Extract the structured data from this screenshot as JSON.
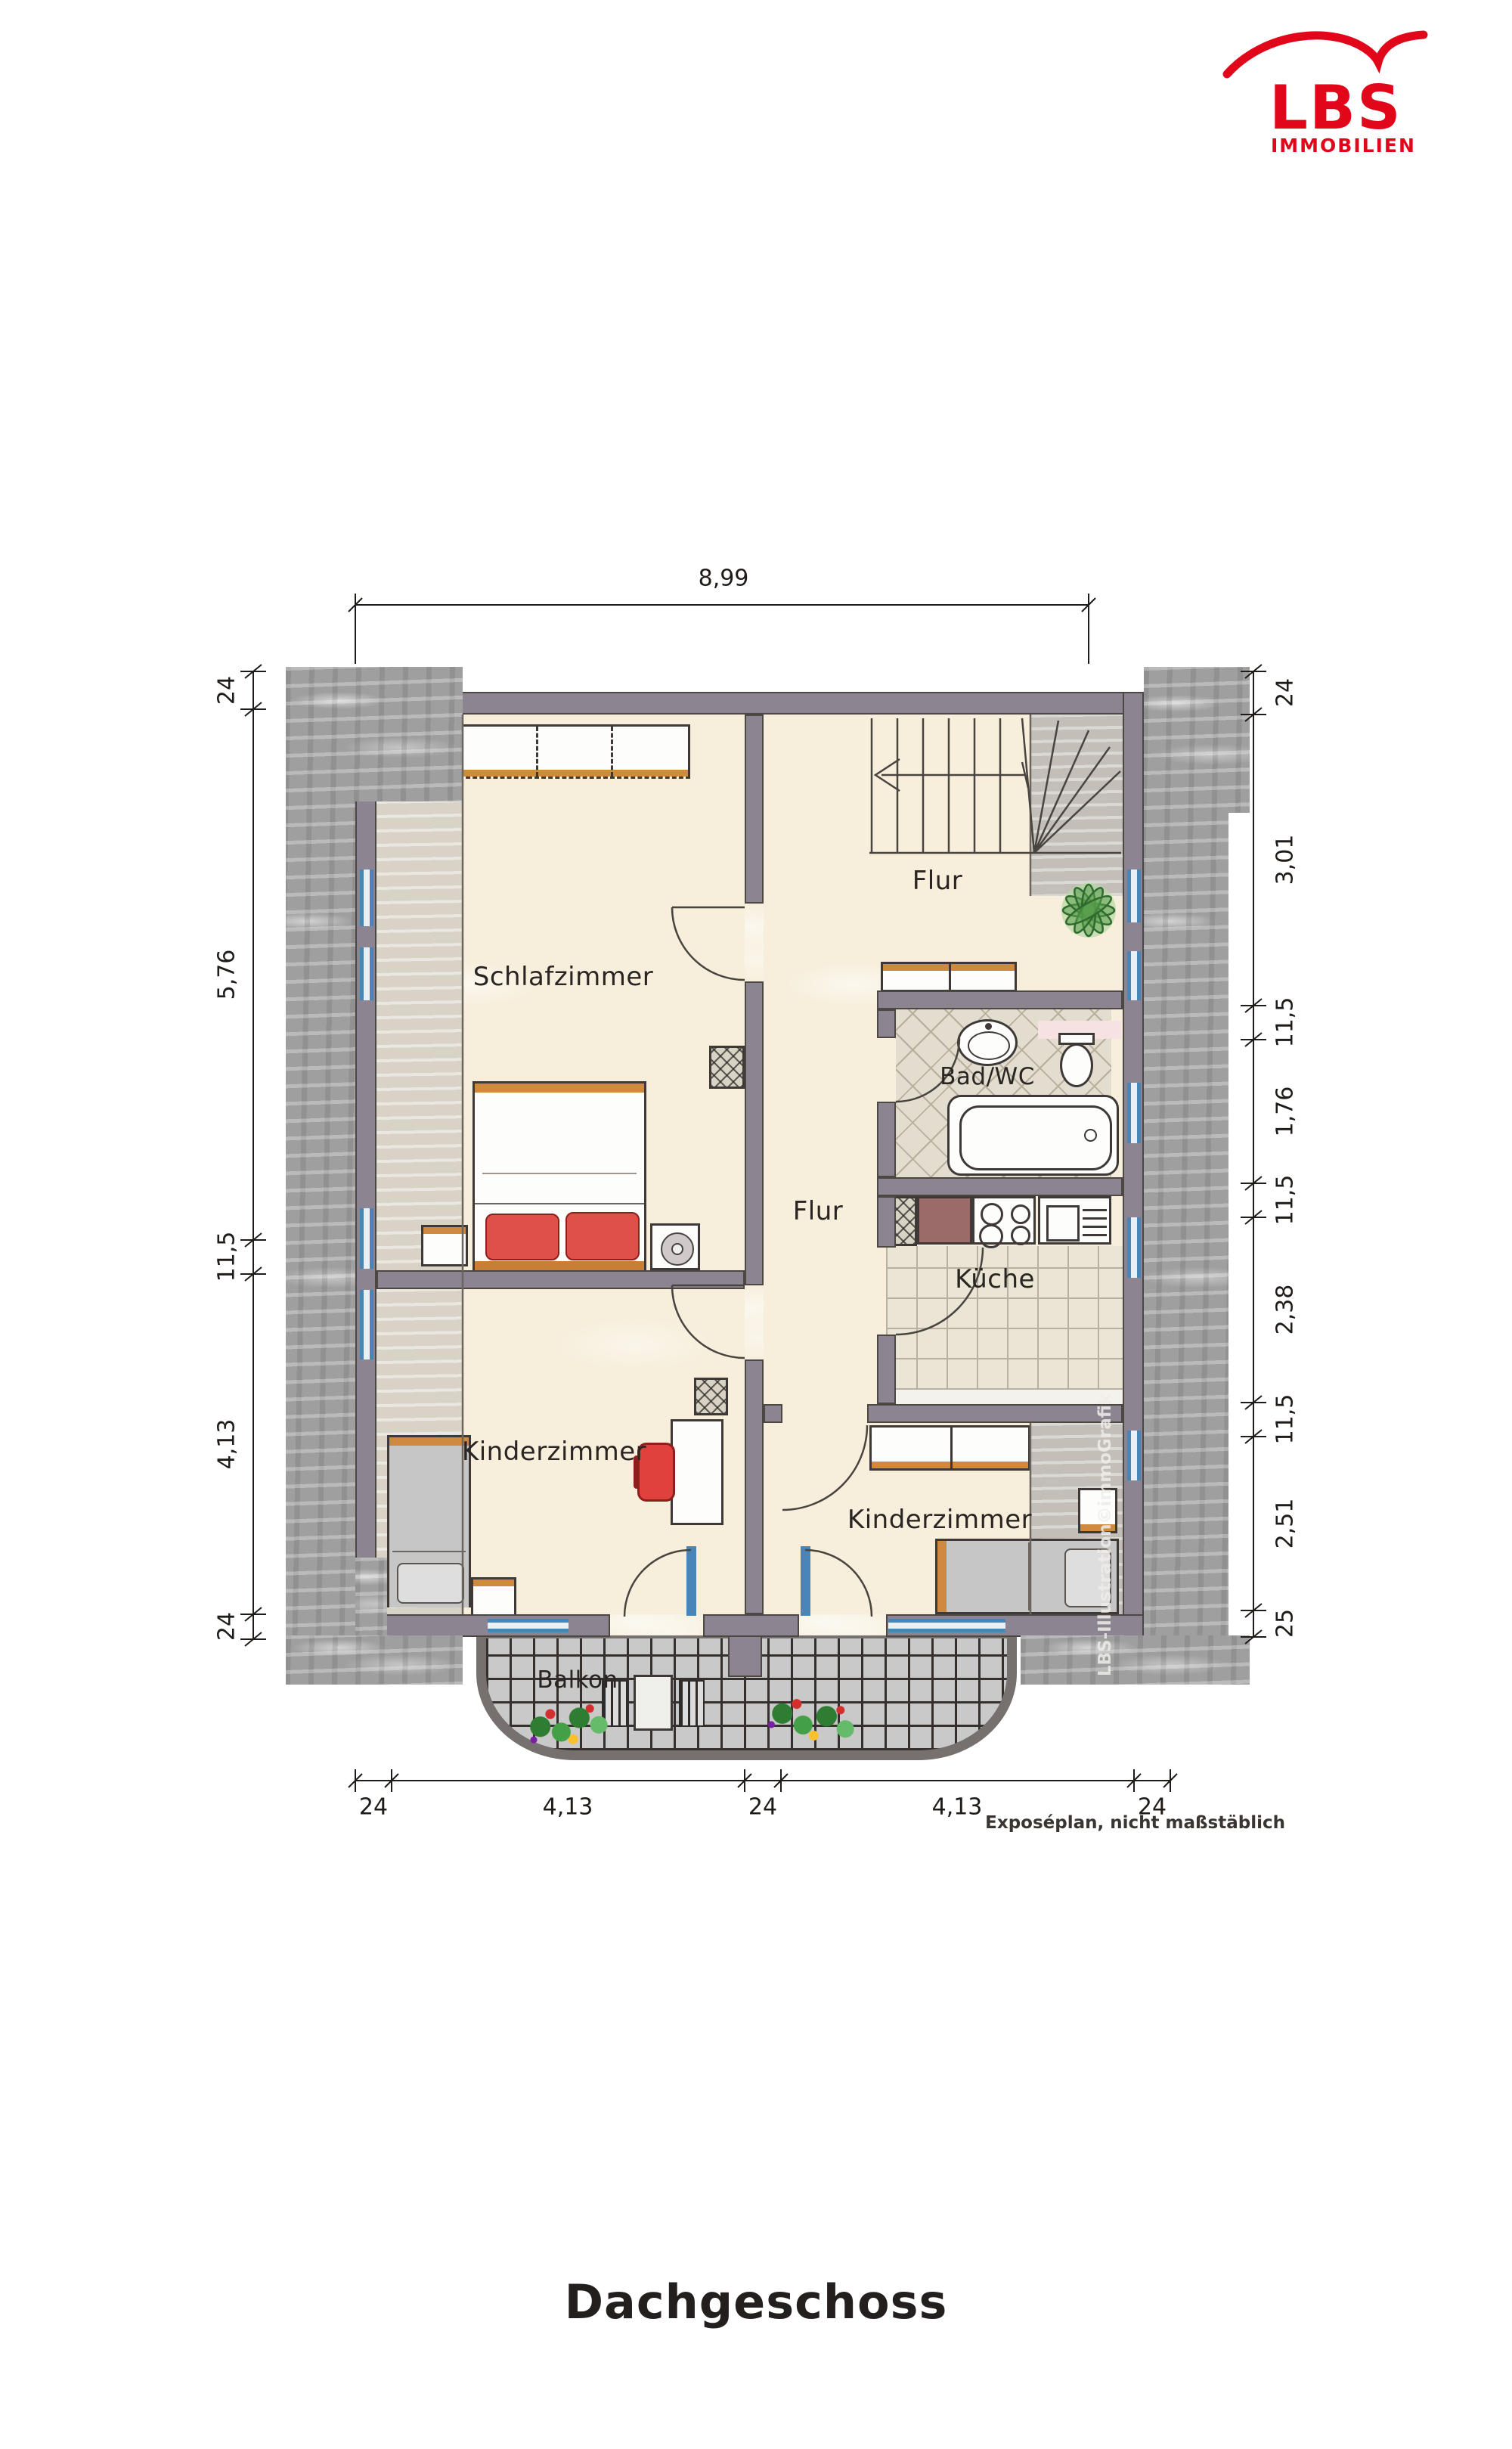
{
  "logo": {
    "name": "LBS",
    "tagline": "IMMOBILIEN"
  },
  "title": "Dachgeschoss",
  "footnote": "Exposéplan, nicht maßstäblich",
  "watermark": "LBS-Illustration©immoGrafik",
  "rooms": [
    {
      "label": "Schlafzimmer"
    },
    {
      "label": "Flur"
    },
    {
      "label": "Bad/WC"
    },
    {
      "label": "Flur"
    },
    {
      "label": "Küche"
    },
    {
      "label": "Kinderzimmer"
    },
    {
      "label": "Kinderzimmer"
    },
    {
      "label": "Balkon"
    }
  ],
  "dimensions": {
    "top": [
      "8,99"
    ],
    "left": [
      "24",
      "5,76",
      "11,5",
      "4,13",
      "24"
    ],
    "right": [
      "24",
      "3,01",
      "11,5",
      "1,76",
      "11,5",
      "2,38",
      "11,5",
      "2,51",
      "25"
    ],
    "bottom": [
      "24",
      "4,13",
      "24",
      "4,13",
      "24"
    ]
  },
  "colors": {
    "logo_red": "#e2061b",
    "wall": "#8d8492",
    "floor_cream": "#f7efdc",
    "window_blue": "#4a85b8",
    "wood_orange": "#d08a3e",
    "accent_red": "#e0504b",
    "plant_green": "#5a9e4d",
    "roof_gray": "#9f9f9f",
    "tile_bath": "#e3ddcf",
    "tile_kitchen": "#ebe5d5"
  }
}
